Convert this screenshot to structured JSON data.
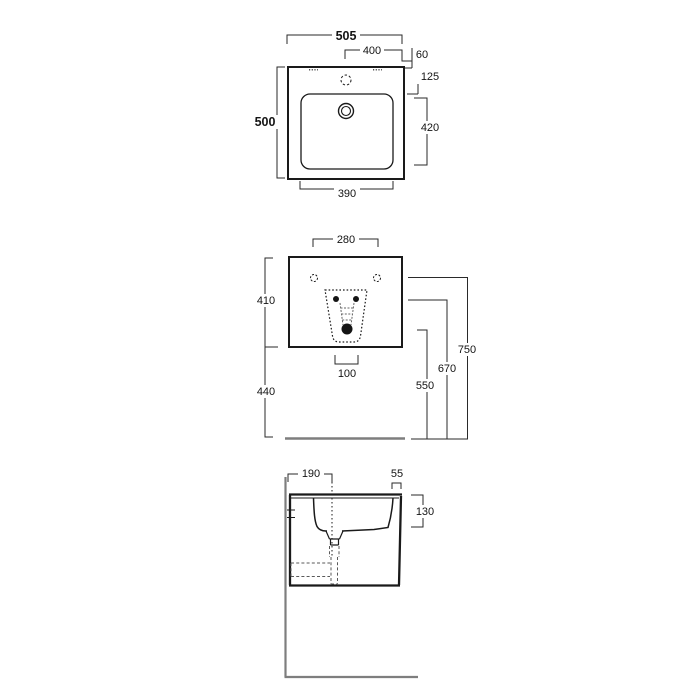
{
  "drawing": {
    "style": {
      "line_color": "#1a1a1a",
      "dim_line_color": "#2a2a2a",
      "wall_floor_color": "#7e7e7e",
      "hidden_detail_color": "#5a5a5a",
      "background": "#ffffff"
    },
    "dims": {
      "plan": {
        "overall_width": "505",
        "upper_width": "400",
        "rear_offset": "60",
        "tap_offset": "125",
        "overall_depth": "500",
        "bowl_length": "420",
        "bowl_width": "390"
      },
      "front": {
        "fixing_span": "280",
        "body_height": "410",
        "clearance_below": "440",
        "drain_span": "100",
        "drain_height": "550",
        "trap_fixing_height": "670",
        "wall_fixing_height": "750"
      },
      "side": {
        "drain_to_wall": "190",
        "front_rim": "55",
        "bowl_depth": "130"
      }
    }
  }
}
